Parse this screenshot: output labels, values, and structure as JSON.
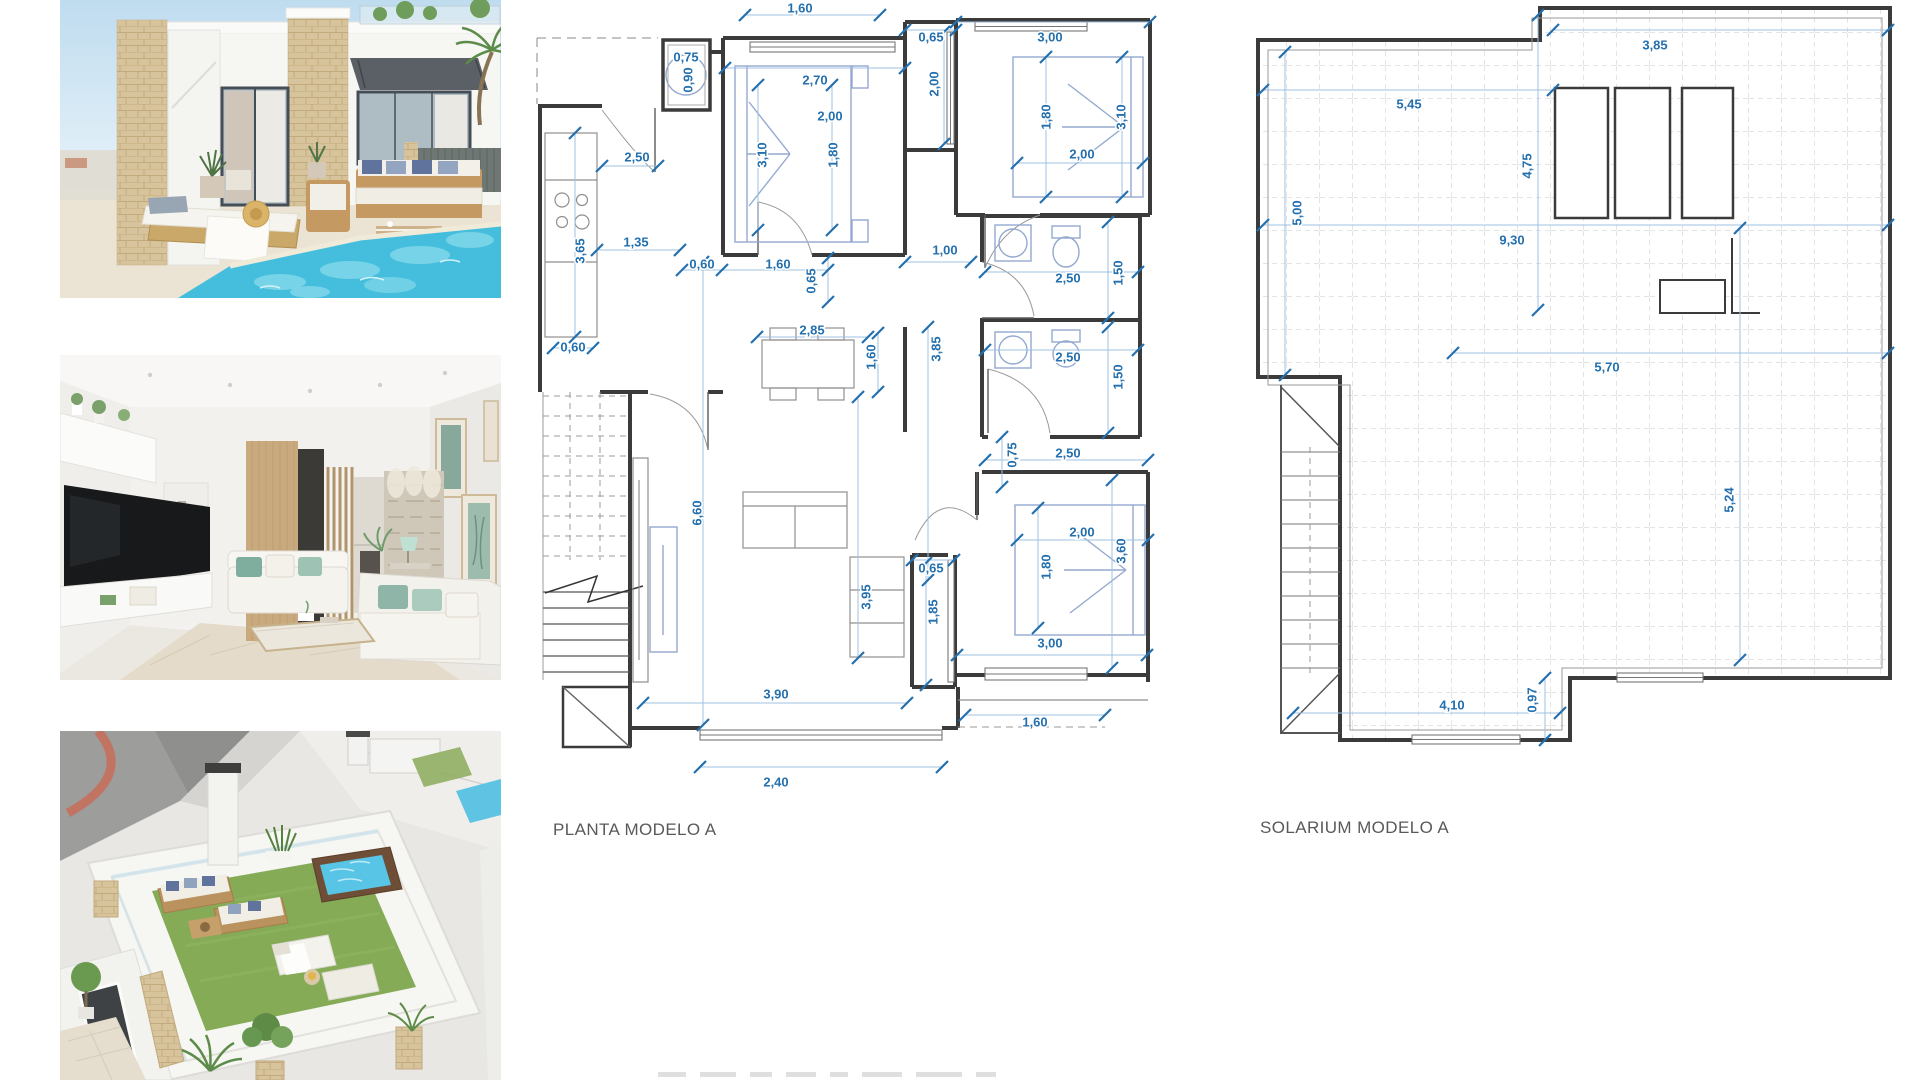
{
  "page": {
    "background": "#ffffff"
  },
  "photos": {
    "villa_pool": {
      "name": "villa-exterior-pool-photo"
    },
    "living_room": {
      "name": "living-room-interior-photo"
    },
    "rooftop": {
      "name": "rooftop-solarium-aerial-photo"
    }
  },
  "floor_plan": {
    "title": "PLANTA MODELO A",
    "dim_color": "#2470AE",
    "wall_color": "#3b3b3b",
    "dimensions": [
      {
        "t": "1,60",
        "x": 800,
        "y": 8,
        "r": 0
      },
      {
        "t": "0,65",
        "x": 931,
        "y": 37,
        "r": 0
      },
      {
        "t": "3,00",
        "x": 1050,
        "y": 37,
        "r": 0
      },
      {
        "t": "0,75",
        "x": 686,
        "y": 57,
        "r": 0
      },
      {
        "t": "0,90",
        "x": 688,
        "y": 80,
        "r": -90
      },
      {
        "t": "2,70",
        "x": 815,
        "y": 80,
        "r": 0
      },
      {
        "t": "2,00",
        "x": 934,
        "y": 84,
        "r": -90
      },
      {
        "t": "2,00",
        "x": 830,
        "y": 116,
        "r": 0
      },
      {
        "t": "3,10",
        "x": 762,
        "y": 155,
        "r": -90
      },
      {
        "t": "1,80",
        "x": 833,
        "y": 155,
        "r": -90
      },
      {
        "t": "1,80",
        "x": 1046,
        "y": 117,
        "r": -90
      },
      {
        "t": "3,10",
        "x": 1121,
        "y": 117,
        "r": -90
      },
      {
        "t": "2,00",
        "x": 1082,
        "y": 154,
        "r": 0
      },
      {
        "t": "2,50",
        "x": 637,
        "y": 157,
        "r": 0
      },
      {
        "t": "1,35",
        "x": 636,
        "y": 242,
        "r": 0
      },
      {
        "t": "3,65",
        "x": 580,
        "y": 251,
        "r": -90
      },
      {
        "t": "0,60",
        "x": 702,
        "y": 264,
        "r": 0
      },
      {
        "t": "1,60",
        "x": 778,
        "y": 264,
        "r": 0
      },
      {
        "t": "0,65",
        "x": 811,
        "y": 281,
        "r": -90
      },
      {
        "t": "1,00",
        "x": 945,
        "y": 250,
        "r": 0
      },
      {
        "t": "2,50",
        "x": 1068,
        "y": 278,
        "r": 0
      },
      {
        "t": "1,50",
        "x": 1118,
        "y": 273,
        "r": -90
      },
      {
        "t": "2,85",
        "x": 812,
        "y": 330,
        "r": 0
      },
      {
        "t": "1,60",
        "x": 871,
        "y": 357,
        "r": -90
      },
      {
        "t": "3,85",
        "x": 936,
        "y": 349,
        "r": -90
      },
      {
        "t": "0,60",
        "x": 573,
        "y": 347,
        "r": 0
      },
      {
        "t": "2,50",
        "x": 1068,
        "y": 357,
        "r": 0
      },
      {
        "t": "1,50",
        "x": 1118,
        "y": 377,
        "r": -90
      },
      {
        "t": "0,75",
        "x": 1012,
        "y": 455,
        "r": -90
      },
      {
        "t": "2,50",
        "x": 1068,
        "y": 453,
        "r": 0
      },
      {
        "t": "6,60",
        "x": 697,
        "y": 513,
        "r": -90
      },
      {
        "t": "2,00",
        "x": 1082,
        "y": 532,
        "r": 0
      },
      {
        "t": "3,60",
        "x": 1121,
        "y": 551,
        "r": -90
      },
      {
        "t": "1,80",
        "x": 1046,
        "y": 567,
        "r": -90
      },
      {
        "t": "0,65",
        "x": 931,
        "y": 568,
        "r": 0
      },
      {
        "t": "3,95",
        "x": 866,
        "y": 597,
        "r": -90
      },
      {
        "t": "1,85",
        "x": 933,
        "y": 612,
        "r": -90
      },
      {
        "t": "3,00",
        "x": 1050,
        "y": 643,
        "r": 0
      },
      {
        "t": "3,90",
        "x": 776,
        "y": 694,
        "r": 0
      },
      {
        "t": "1,60",
        "x": 1035,
        "y": 722,
        "r": 0
      },
      {
        "t": "2,40",
        "x": 776,
        "y": 782,
        "r": 0
      }
    ]
  },
  "solarium_plan": {
    "title": "SOLARIUM MODELO A",
    "dimensions": [
      {
        "t": "3,85",
        "x": 1655,
        "y": 45,
        "r": 0
      },
      {
        "t": "5,45",
        "x": 1409,
        "y": 104,
        "r": 0
      },
      {
        "t": "4,75",
        "x": 1527,
        "y": 166,
        "r": -90
      },
      {
        "t": "5,00",
        "x": 1297,
        "y": 213,
        "r": -90
      },
      {
        "t": "9,30",
        "x": 1512,
        "y": 240,
        "r": 0
      },
      {
        "t": "5,70",
        "x": 1607,
        "y": 367,
        "r": 0
      },
      {
        "t": "5,24",
        "x": 1729,
        "y": 500,
        "r": -90
      },
      {
        "t": "4,10",
        "x": 1452,
        "y": 705,
        "r": 0
      },
      {
        "t": "0,97",
        "x": 1532,
        "y": 700,
        "r": -90
      }
    ]
  }
}
